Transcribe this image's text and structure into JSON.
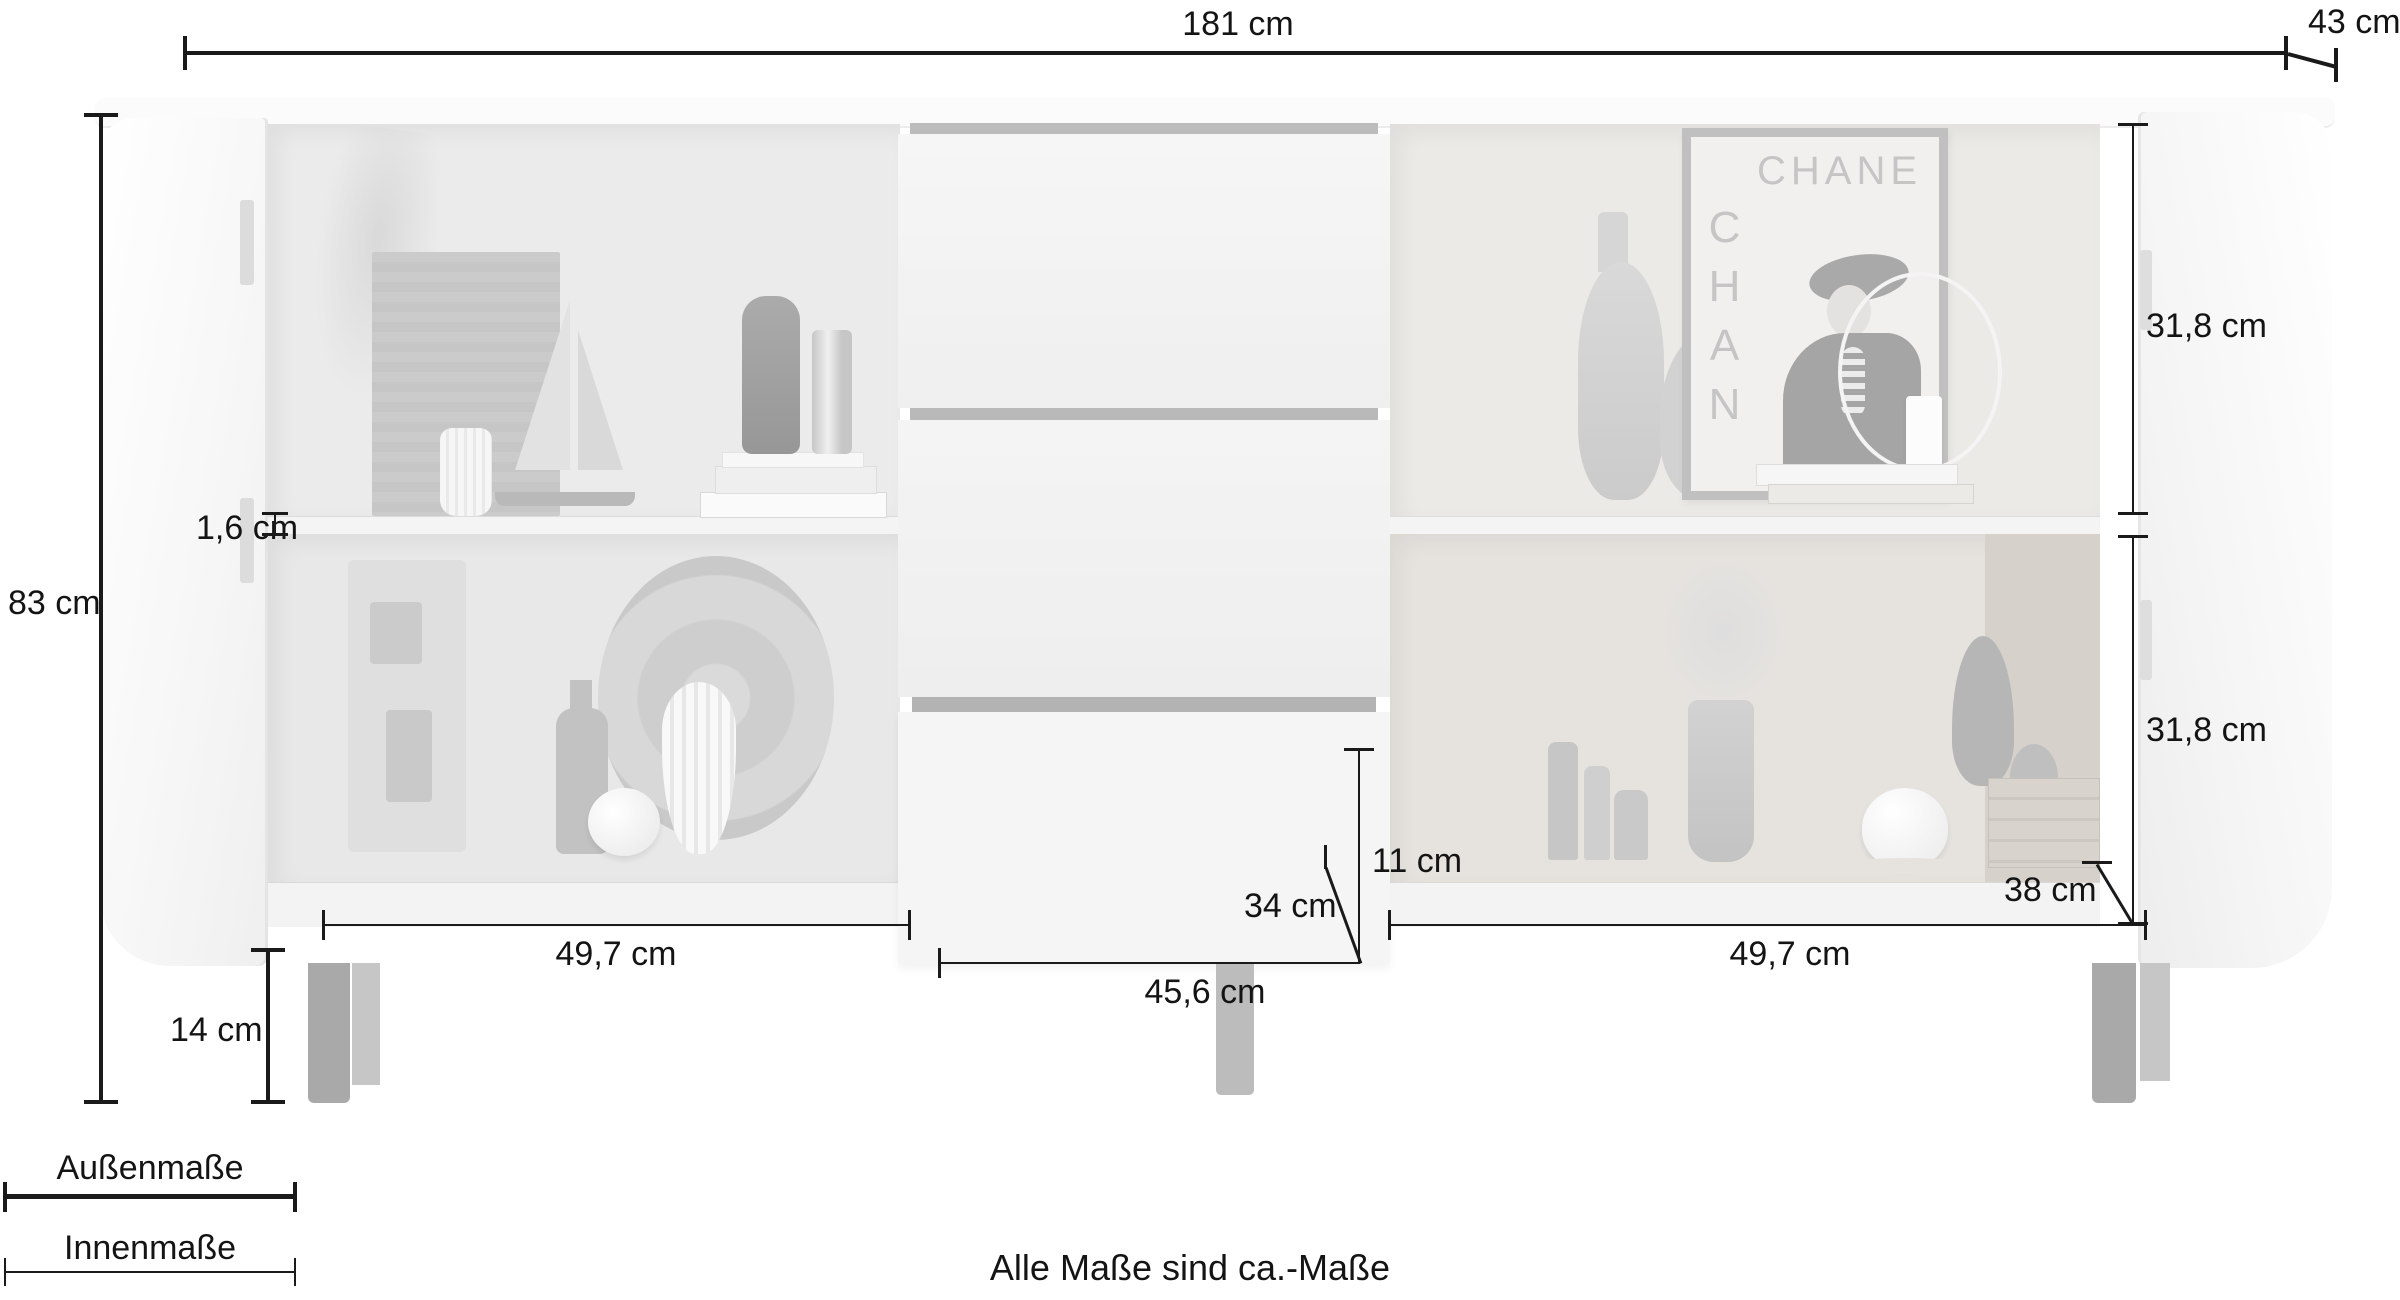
{
  "dim_labels": {
    "total_width": "181 cm",
    "depth": "43 cm",
    "height": "83 cm",
    "shelf_thickness": "1,6 cm",
    "right_inner_top": "31,8 cm",
    "right_inner_bottom": "31,8 cm",
    "left_inner_width": "49,7 cm",
    "right_inner_width": "49,7 cm",
    "drawer_inner_width": "45,6 cm",
    "drawer_inner_depth": "34 cm",
    "drawer_inner_height": "11 cm",
    "inner_depth": "38 cm",
    "leg_height": "14 cm"
  },
  "legend": {
    "outer_label": "Außenmaße",
    "inner_label": "Innenmaße"
  },
  "note": "Alle Maße sind ca.-Maße",
  "poster": {
    "brand_horizontal": "CHANE",
    "brand_vertical": "CHAN"
  },
  "colors": {
    "dimension_line": "#1a1a1a",
    "cabinet_body": "#f7f7f7",
    "interior_left": "#eaeaea",
    "interior_right": "#e9e6e3",
    "drawer_gap": "#b9b9b9",
    "leg": "#a9a9a9",
    "background": "#ffffff"
  }
}
